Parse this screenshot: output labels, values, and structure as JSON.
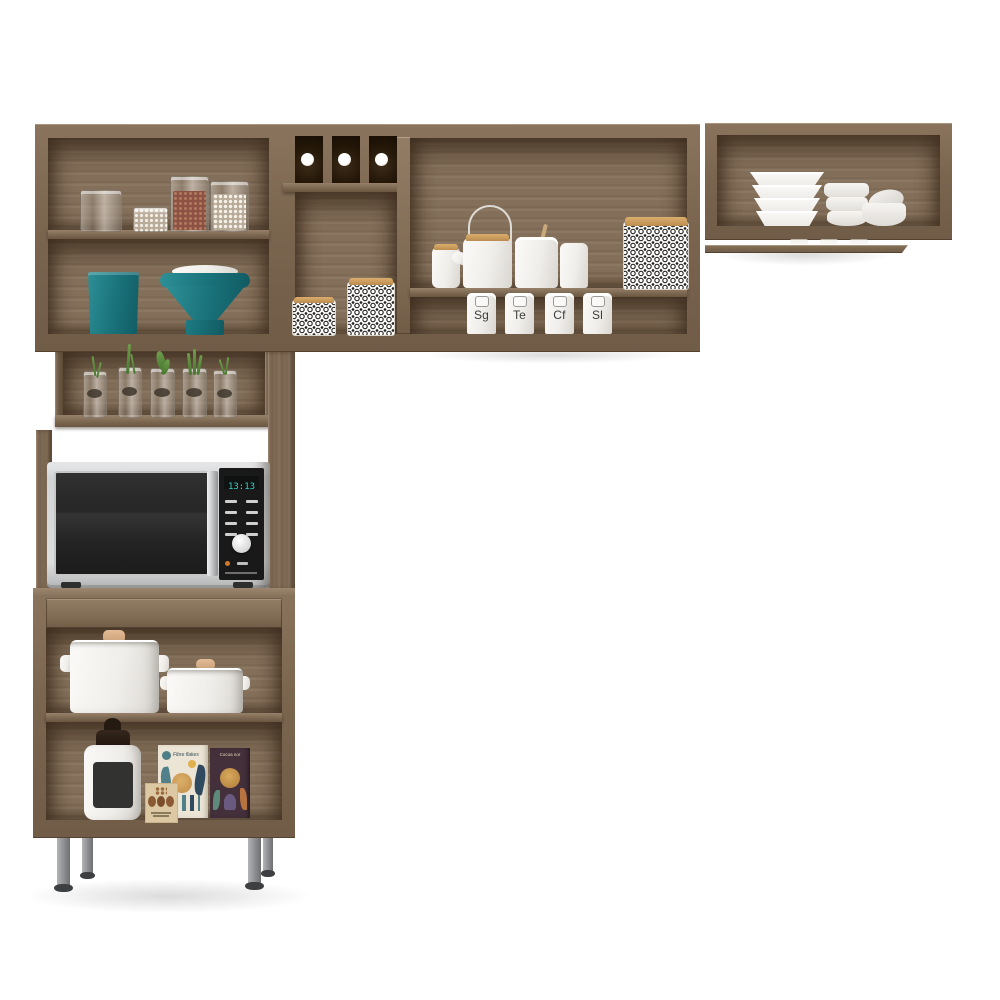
{
  "scene": {
    "description": "Modular kitchen cabinet set in walnut-toned wood with wall cabinets, microwave tower and base cabinet, styled with kitchenware",
    "background_color": "#ffffff",
    "wood_color": "#7a654f",
    "accent_teal": "#1b747c"
  },
  "upper_left_cabinet": {
    "shelf1_items": [
      "empty glass jar",
      "small jar of white beans",
      "tall jar of red beans",
      "tall jar of white beans"
    ],
    "shelf2_items": [
      "teal canister",
      "teal funnel with white lid"
    ]
  },
  "wine_rack": {
    "bottle_count": 3
  },
  "middle_cabinet": {
    "pattern_canisters": 2,
    "shelf_items": [
      "small lidded jar",
      "white teapot with wire handle",
      "large white jar",
      "small white jar",
      "patterned square canister"
    ],
    "spice_canisters": [
      {
        "label": "Sg"
      },
      {
        "label": "Te"
      },
      {
        "label": "Cf"
      },
      {
        "label": "Sl"
      }
    ]
  },
  "right_cabinet": {
    "items": [
      "stack of four square bowls",
      "stack of three round bowls",
      "two small bowls"
    ]
  },
  "herb_shelf": {
    "jar_count": 5
  },
  "microwave": {
    "display_time": "13:13",
    "body_color": "#d6d7d8",
    "display_color": "#35d0c8"
  },
  "base_cabinet": {
    "shelf_items": [
      "large white pot with lid",
      "small white pot with lid"
    ],
    "lower_items": [
      "white chalkboard jar",
      "coffee bean card",
      "cereal box",
      "cocoa box"
    ],
    "cereal_box_label": "Fibre flakes",
    "cocoa_box_label": "Cocoa nor"
  },
  "legs": {
    "count": 4,
    "color": "#8b8d90"
  }
}
